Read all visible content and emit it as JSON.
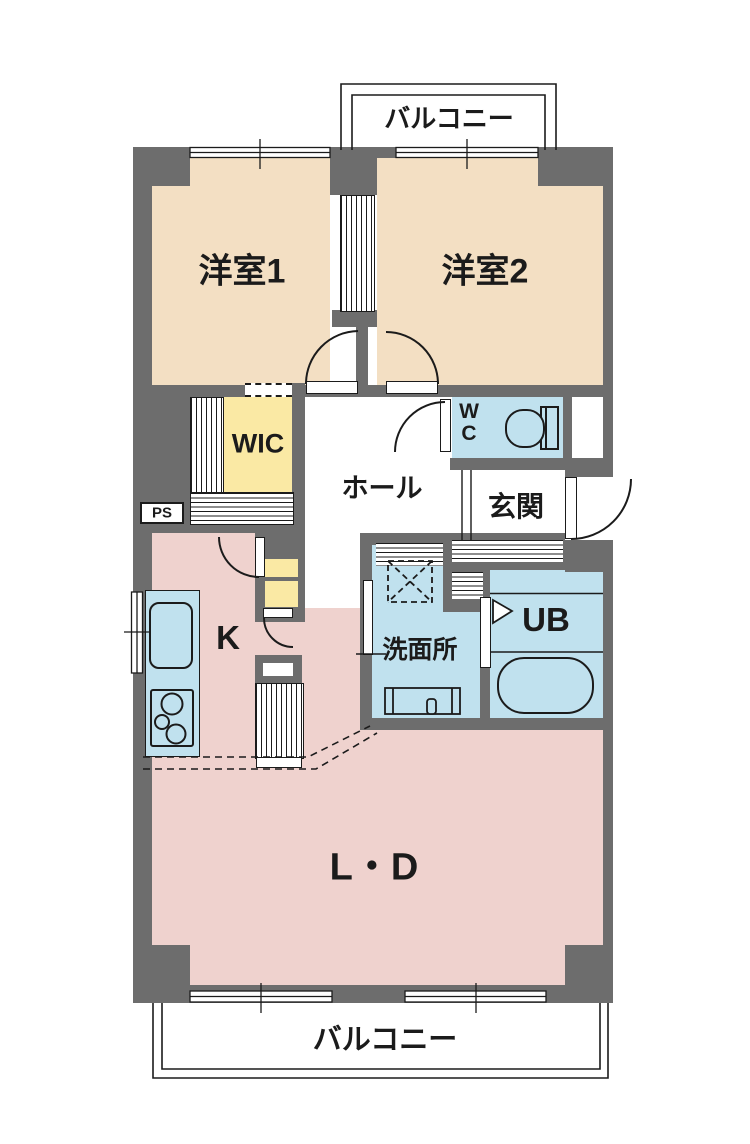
{
  "plan": {
    "type": "floor-plan",
    "labels": {
      "balcony_top": "バルコニー",
      "room1": "洋室1",
      "room2": "洋室2",
      "wic": "WIC",
      "hall": "ホール",
      "wc_line1": "W",
      "wc_line2": "C",
      "genkan": "玄関",
      "ps": "PS",
      "kitchen": "K",
      "washroom": "洗面所",
      "unit_bath": "UB",
      "living_dining": "L・D",
      "balcony_bottom": "バルコニー"
    },
    "colors": {
      "wall": "#6d6d6d",
      "western_room": "#f3dfc3",
      "living_dining_kitchen": "#efd2ce",
      "storage": "#fae9a4",
      "wet_area": "#c0e1ee",
      "line": "#1b1b1b",
      "background": "#ffffff"
    },
    "icons": [
      "toilet-icon",
      "bathtub-icon",
      "washing-machine-icon",
      "gas-stove-icon",
      "kitchen-sink-icon",
      "vanity-icon",
      "folding-door-icon",
      "door-swing-icon",
      "window-icon"
    ]
  }
}
